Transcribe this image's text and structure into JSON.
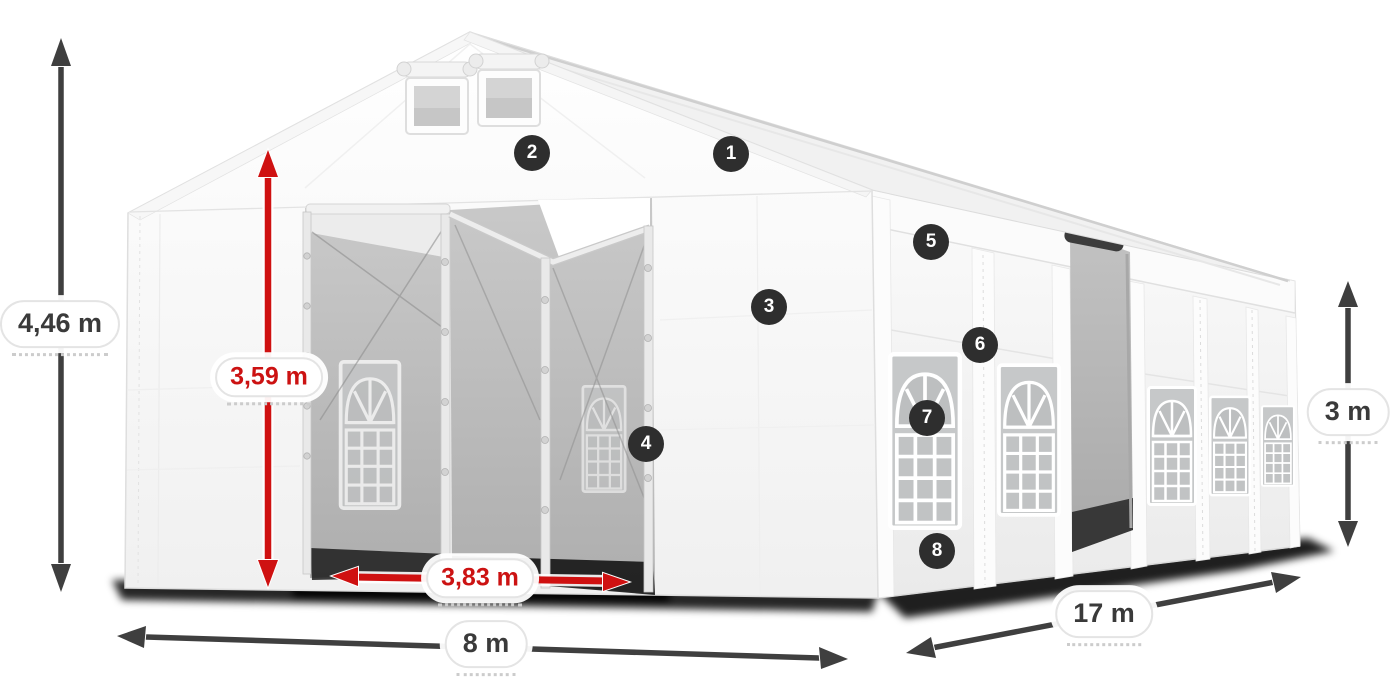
{
  "colors": {
    "arrow_dark": "#3f3f3f",
    "arrow_red": "#cf1111",
    "badge_bg": "#2e2e2e",
    "badge_text": "#ffffff",
    "pill_bg": "#ffffff",
    "pill_border": "#e4e4e4",
    "label_text_dark": "#3a3a3a",
    "label_text_red": "#cc1212"
  },
  "dimensions": {
    "total_height": "4,46 m",
    "entrance_height": "3,59 m",
    "entrance_width": "3,83 m",
    "width": "8 m",
    "length": "17 m",
    "side_height": "3 m"
  },
  "badges": [
    {
      "number": "1"
    },
    {
      "number": "2"
    },
    {
      "number": "3"
    },
    {
      "number": "4"
    },
    {
      "number": "5"
    },
    {
      "number": "6"
    },
    {
      "number": "7"
    },
    {
      "number": "8"
    }
  ]
}
